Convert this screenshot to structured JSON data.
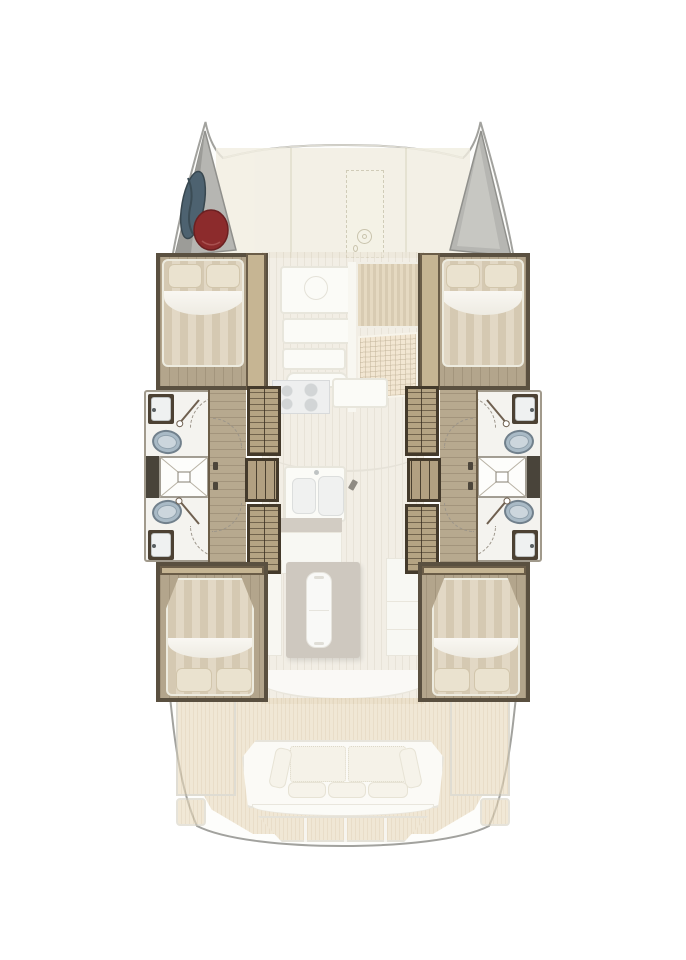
{
  "plan": {
    "type": "floor-plan",
    "subject": "sailing-catamaran-interior-deck-plan",
    "orientation": "bow-up",
    "symmetry": "port-starboard-mirrored",
    "visible_text": [],
    "areas": {
      "bow": {
        "port_bow_locker": {
          "label": "port bow locker",
          "items": [
            "sail-bag",
            "fender"
          ]
        },
        "starboard_bow_locker": {
          "label": "starboard bow locker",
          "items": []
        }
      },
      "foredeck": {
        "label": "foredeck",
        "features": [
          "deck-panels",
          "anchor-locker-hatch-dashed",
          "windlass-icon"
        ]
      },
      "port_hull": {
        "forward_cabin": {
          "label": "forward double cabin",
          "fixtures": [
            "double-bed",
            "pillow",
            "pillow",
            "wood-floor"
          ]
        },
        "forward_bathroom": {
          "label": "forward head",
          "fixtures": [
            "washbasin",
            "toilet",
            "door"
          ]
        },
        "shared_shower": {
          "label": "shower compartment",
          "fixtures": [
            "shower-pan"
          ]
        },
        "aft_bathroom": {
          "label": "aft head",
          "fixtures": [
            "toilet",
            "washbasin",
            "door"
          ]
        },
        "companionway": {
          "label": "stairs to hull",
          "fixtures": [
            "stair-run-forward",
            "landing",
            "stair-run-aft"
          ]
        },
        "aft_cabin": {
          "label": "aft double cabin",
          "fixtures": [
            "double-bed",
            "pillow",
            "pillow",
            "wood-floor"
          ]
        }
      },
      "starboard_hull": {
        "forward_cabin": {
          "label": "forward double cabin",
          "fixtures": [
            "double-bed",
            "pillow",
            "pillow",
            "wood-floor"
          ]
        },
        "forward_bathroom": {
          "label": "forward head",
          "fixtures": [
            "washbasin",
            "toilet",
            "door"
          ]
        },
        "shared_shower": {
          "label": "shower compartment",
          "fixtures": [
            "shower-pan"
          ]
        },
        "aft_bathroom": {
          "label": "aft head",
          "fixtures": [
            "toilet",
            "washbasin",
            "door"
          ]
        },
        "companionway": {
          "label": "stairs to hull",
          "fixtures": [
            "stair-run-forward",
            "landing",
            "stair-run-aft"
          ]
        },
        "aft_cabin": {
          "label": "aft double cabin",
          "fixtures": [
            "double-bed",
            "pillow",
            "pillow",
            "wood-floor"
          ]
        }
      },
      "saloon": {
        "label": "main-deck saloon and galley",
        "fixtures": [
          "saloon-table",
          "bench-seating",
          "sideboard-slatted",
          "worktop-grid",
          "galley-stove",
          "galley-counter",
          "galley-double-sink",
          "island-unit",
          "aft-cabinets",
          "curved-bulkhead"
        ]
      },
      "cockpit": {
        "label": "aft cockpit",
        "fixtures": [
          "teak-deck",
          "aft-bench",
          "back-cushion",
          "back-cushion",
          "seat-pillow",
          "seat-pillow",
          "seat-pillow",
          "transom-steps",
          "port-swim-step",
          "starboard-swim-step"
        ]
      }
    },
    "palette": {
      "background": "#ffffff",
      "hull_outline": "#a2a29e",
      "deck_cream": "#f1eee1",
      "bow_locker_gray": "#b6b6b2",
      "sail_bag_blue": "#4d6270",
      "fender_red": "#8c2b2c",
      "dark_wood_wall": "#5a5040",
      "cabin_floor_wood": "#b3a58c",
      "duvet_stripe_a": "#d5c9b2",
      "duvet_stripe_b": "#e2d8c5",
      "bathroom_white": "#f4f3ef",
      "toilet_blue_gray": "#a9bac6",
      "stair_wood": "#b5a483",
      "saloon_floor": "#ece6d9",
      "island_taupe": "#b2a99b",
      "cockpit_teak": "#e2d2b3"
    }
  }
}
